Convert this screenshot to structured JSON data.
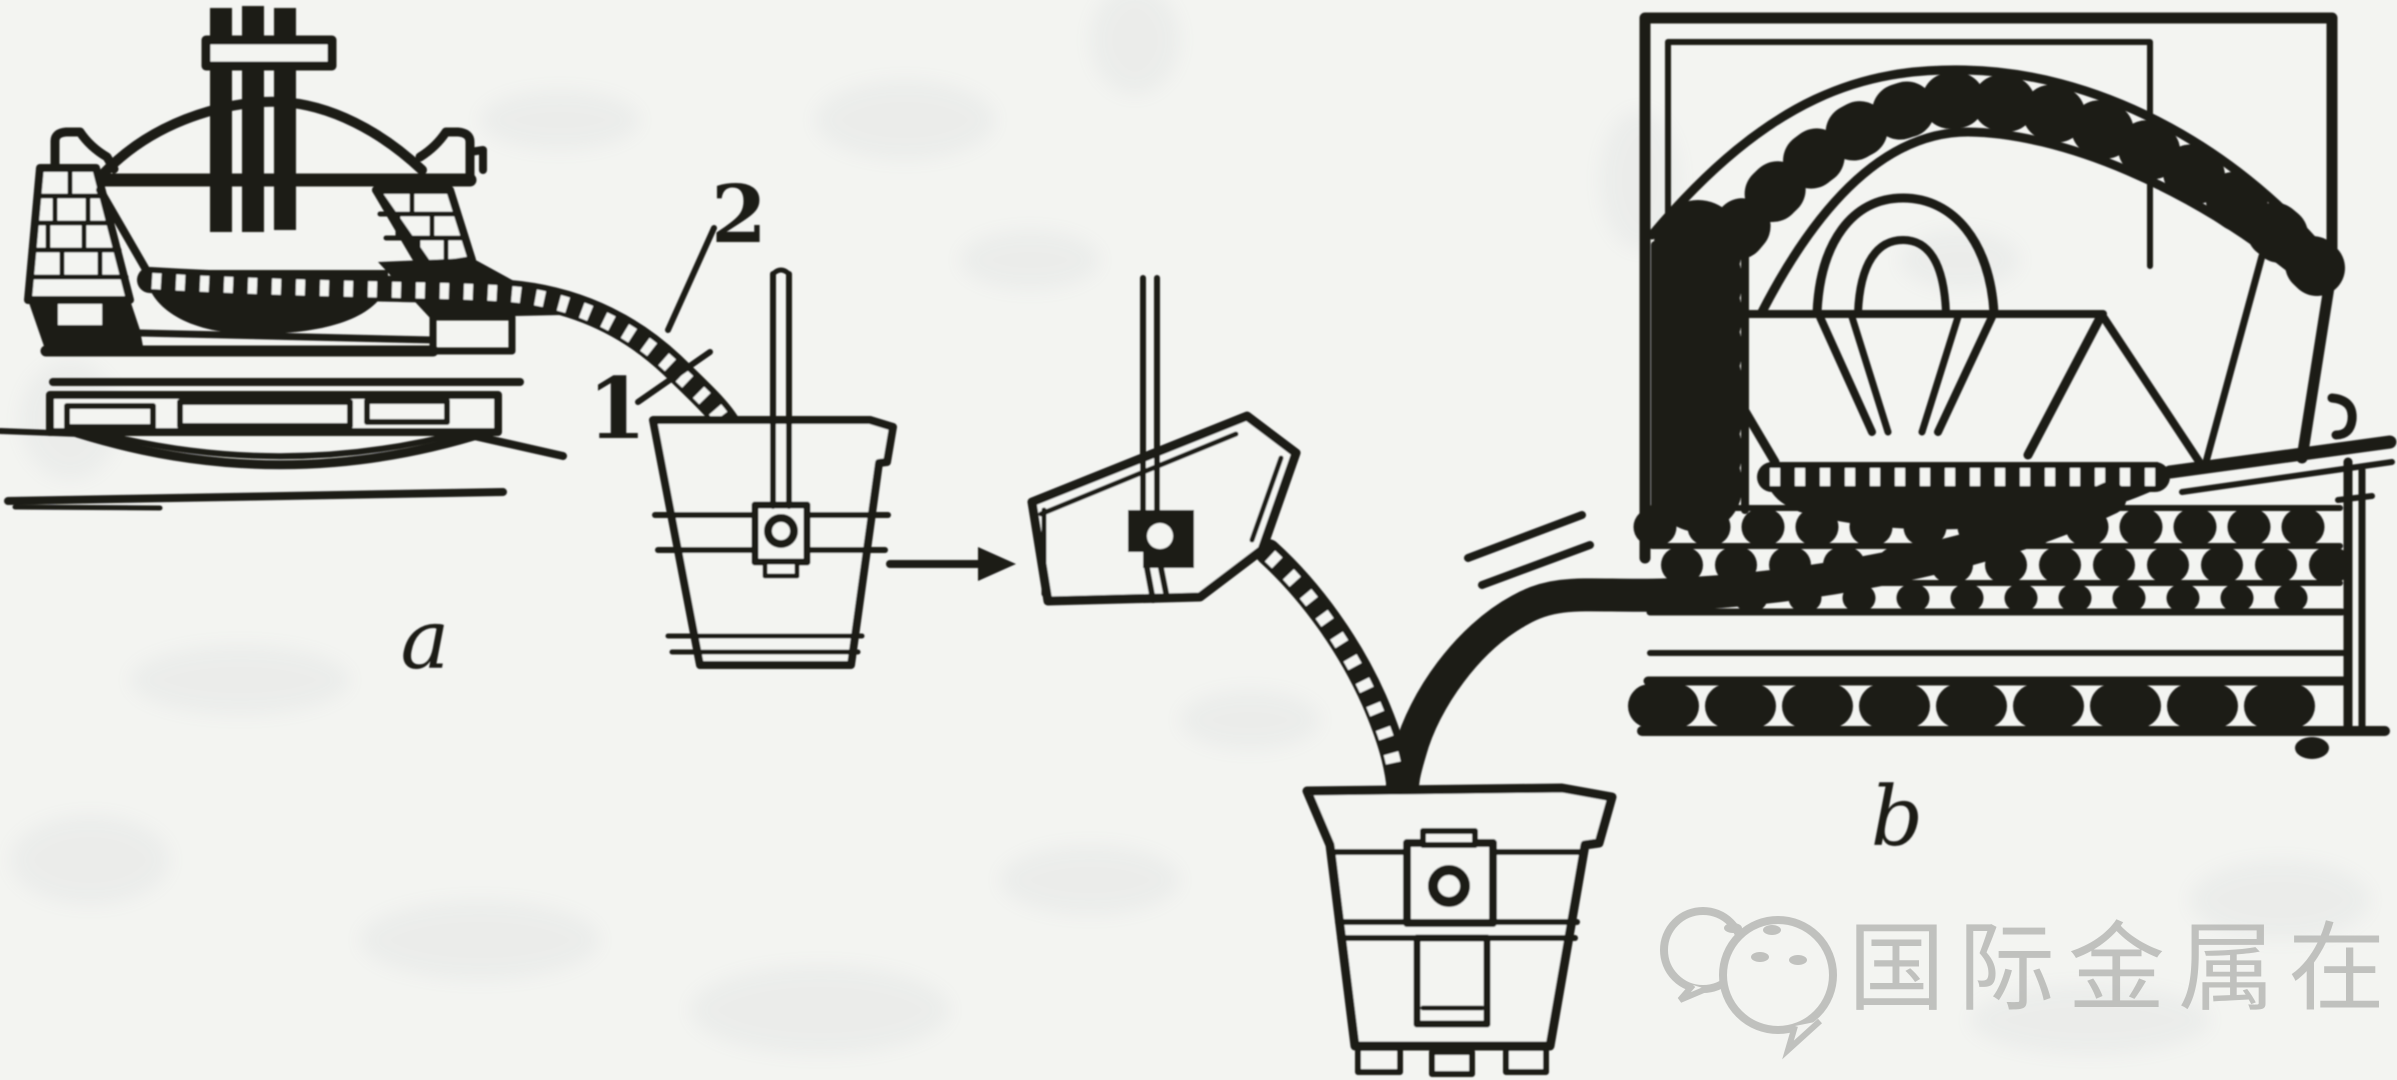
{
  "figure": {
    "callouts": {
      "top": "2",
      "bottom": "1"
    },
    "panels": {
      "left": "a",
      "right": "b"
    }
  },
  "watermark": {
    "text": "国际金属在线",
    "logo": "chat-bubbles-logo",
    "color": "#bcbdba"
  },
  "palette": {
    "ink": "#1c1b19",
    "paper": "#f3f4f1"
  }
}
